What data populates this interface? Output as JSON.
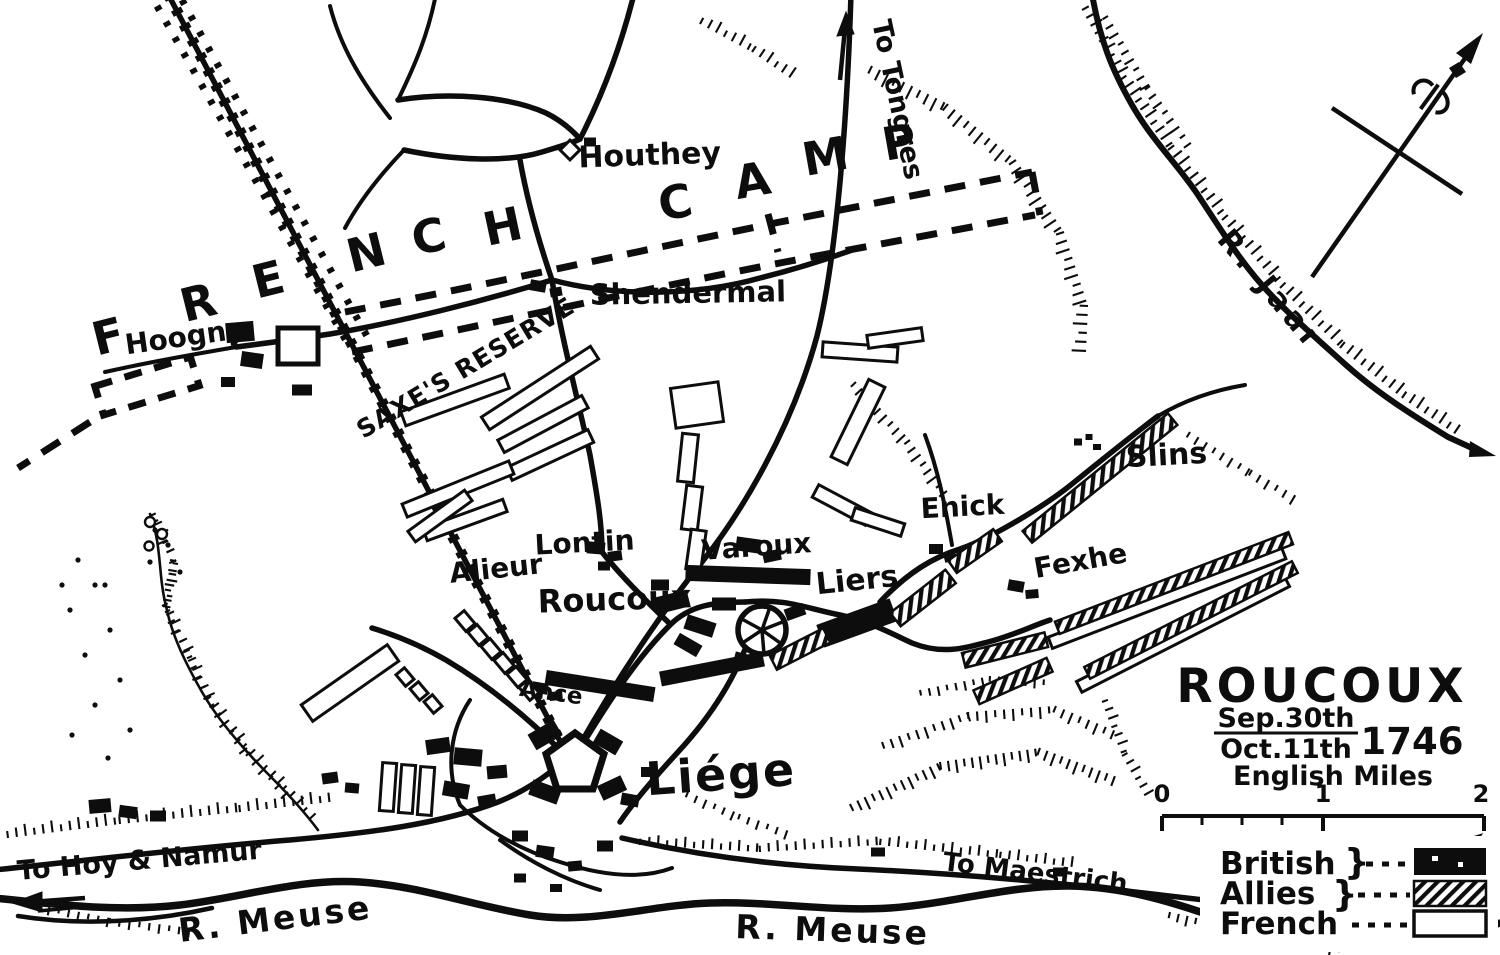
{
  "map": {
    "name": "Battle of Roucoux map",
    "colors": {
      "ink": "#0d0d0d",
      "paper": "#ffffff"
    },
    "camp_letters": [
      "F",
      "R",
      "E",
      "N",
      "C",
      "H",
      "C",
      "A",
      "M",
      "P"
    ],
    "camp_label": "FRENCH CAMP",
    "labels": {
      "houthey": "Houthey",
      "shendermal": "Shendermal",
      "saxes_reserve": "SAXE'S RESERVE",
      "hoogny": "Hoogny",
      "to_tongres": "To Tongres",
      "r_jaar": "R. Jaar",
      "alieur": "Alieur",
      "lontin": "Lontin",
      "roucoux_village": "Roucoux",
      "varoux": "Varoux",
      "liers": "Liers",
      "enick": "Enick",
      "fexhe": "Fexhe",
      "slins": "Slins",
      "liege": "Liége",
      "ance": "Ance",
      "to_hoy_namur": "To Hoy & Namur",
      "r_meuse_west": "R. Meuse",
      "r_meuse_east": "R. Meuse",
      "to_maestrich": "To Maestrich"
    },
    "title_block": {
      "title": "ROUCOUX",
      "date_top": "Sep.30th",
      "date_bottom": "Oct.11th",
      "year": "1746",
      "scale_caption": "English Miles"
    },
    "scale": {
      "start": "0",
      "mid": "1",
      "end": "2"
    },
    "legend": {
      "items": [
        {
          "label": "British",
          "brace": "}",
          "swatch": "british-solid-black"
        },
        {
          "label": "Allies",
          "brace": "}",
          "swatch": "allies-diagonal-hatch"
        },
        {
          "label": "French",
          "brace": "",
          "swatch": "french-white-outline"
        }
      ]
    },
    "compass": {
      "icon": "compass-rose-icon",
      "north_marker": "fleur-de-lis"
    }
  }
}
